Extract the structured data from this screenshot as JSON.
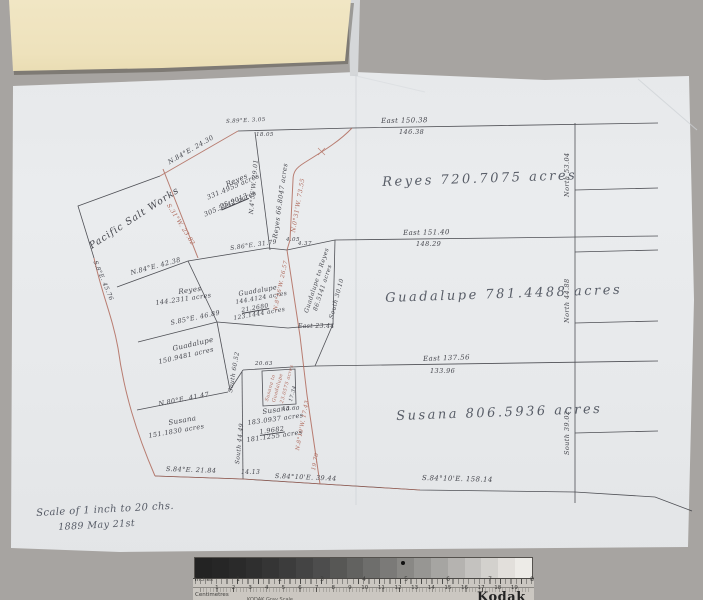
{
  "colors": {
    "background": "#a7a4a1",
    "paper": "#e9ebed",
    "card": "#f0e5c2",
    "ink_black": "#3e3f45",
    "ink_red": "#ae685a"
  },
  "map": {
    "scale_note": {
      "line1": "Scale of 1 inch to 20 chs.",
      "line2": "1889 May 21st"
    },
    "parcels": {
      "reyes_large": "Reyes  720.7075  acres",
      "guadalupe_large": "Guadalupe  781.4488  acres",
      "susana_large": "Susana  806.5936 acres",
      "pacific_salt_works": "Pacific Salt Works"
    },
    "labels": {
      "east_top": "East  150.38",
      "east_top_b": "146.38",
      "east_mid": "East  151.40",
      "east_mid_b": "148.29",
      "east_low": "East  137.56",
      "east_low_b": "133.96",
      "south_bottom": "S.84°10'E.  158.14",
      "north_1": "North  53.04",
      "north_2": "North  44.88",
      "south_3": "South  39.02",
      "reyes_sm": "Reyes",
      "reyes_sm_1": "331.4955 acres",
      "reyes_sm_2": "25.9013",
      "reyes_sm_3": "305.5942 acres",
      "reyes_strip": "Reyes  66.8047 acres",
      "strip_bearing_red": "N.0°31'W. 73.55",
      "n456w": "N.4°56'W. 29.01",
      "red_diag": "S.31°W. 23.82",
      "apex": "S.89°E. 3.05",
      "apex_b": "18.05",
      "n84_top": "N.84°E.  24.30",
      "n84_mid": "N.84°E. 42.38",
      "s8e": "S.8°E. 45.76",
      "reyes_mid": "Reyes",
      "reyes_mid_v": "144.2311 acres",
      "s85e": "S.85°E. 46.89",
      "guad_mid": "Guadalupe",
      "guad_mid_1": "144.4124 acres",
      "guad_mid_2": "21.2680",
      "guad_mid_3": "123.1444 acres",
      "strip2a": "Guadalupe to Reyes",
      "strip2b": "86.5141 acres",
      "south_3010": "South 30.10",
      "east_2344": "East 23.44",
      "n816w": "N.8°16'W. 26.57",
      "s86e": "S.86°E. 31.79",
      "t405": "4.05",
      "t437": "4.37",
      "guad_low": "Guadalupe",
      "guad_low_v": "150.9481 acres",
      "south_6052": "South 60.52",
      "n80e": "N.80°E. 41.47",
      "susana_low": "Susana",
      "susana_low_v": "151.1830 acres",
      "susana_mid": "Susana",
      "susana_mid_1": "183.0937 acres",
      "susana_mid_2": "1.9682",
      "susana_mid_3": "181.1255 acres",
      "south_4449": "South 44.49",
      "n810w": "N.8°10'W. 17.43",
      "t1970": "19.70",
      "t2063": "20.63",
      "box_a": "Susana to",
      "box_b": "Guadalupe",
      "box_c": "23.0575 acres",
      "box_d": "17.34",
      "t1360": "13.60",
      "bottom_1": "S.84°E. 21.84",
      "bottom_2": "14.13",
      "bottom_3": "S.84°10'E. 39.44"
    }
  },
  "ruler": {
    "inches_label": "Inches",
    "centimetres_label": "Centimetres",
    "brand": "Kodak",
    "brand_small": "KODAK Gray Scale",
    "inch_numbers": [
      "1",
      "2",
      "3",
      "4",
      "5",
      "6",
      "7",
      "8"
    ],
    "cm_numbers": [
      "1",
      "2",
      "3",
      "4",
      "5",
      "6",
      "7",
      "8",
      "9",
      "10",
      "11",
      "12",
      "13",
      "14",
      "15",
      "16",
      "17",
      "18",
      "19"
    ],
    "wedge_colors": [
      "#232323",
      "#262626",
      "#2a2a2a",
      "#2f2f2f",
      "#353535",
      "#3c3c3c",
      "#444444",
      "#4d4d4d",
      "#575755",
      "#626260",
      "#6e6e6c",
      "#7b7a78",
      "#898885",
      "#979693",
      "#a6a5a2",
      "#b5b3b0",
      "#c4c2bf",
      "#d3d1cd",
      "#e2dfdb",
      "#edebe7"
    ]
  }
}
